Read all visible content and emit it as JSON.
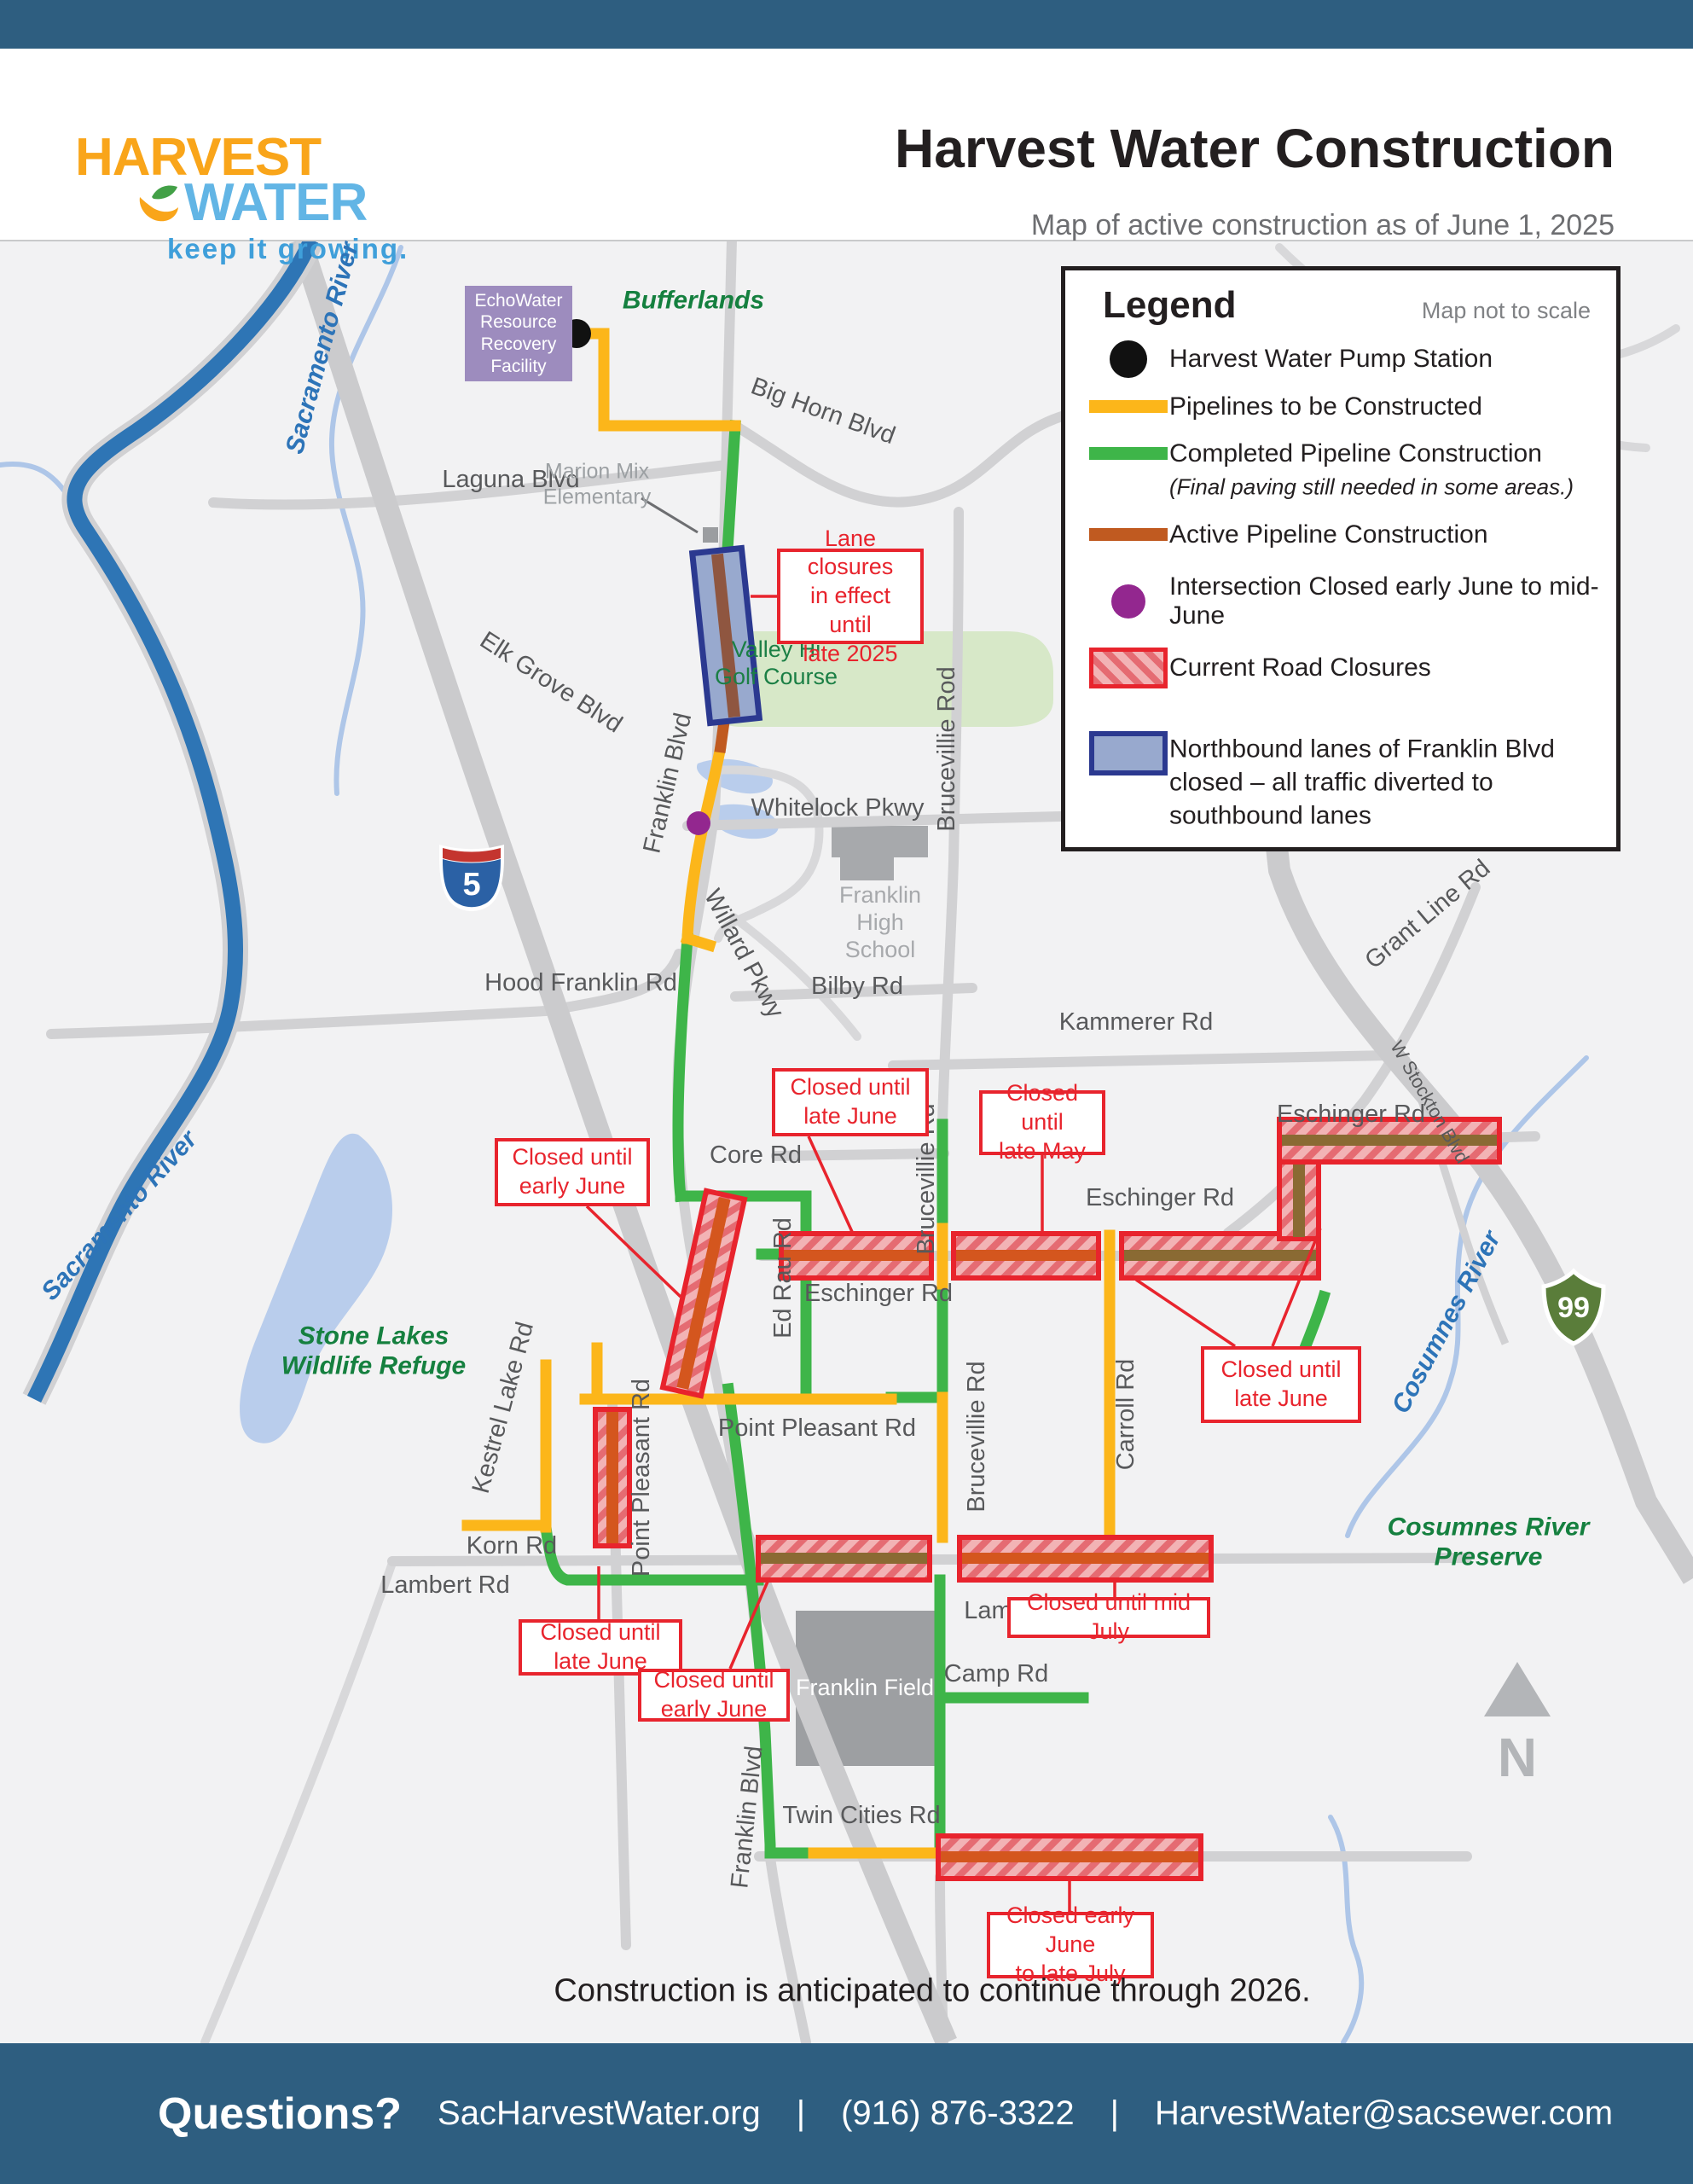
{
  "header": {
    "logo_line1": "HARVEST",
    "logo_line2": "WATER",
    "logo_tagline": "keep it growing.",
    "title": "Harvest Water Construction",
    "subtitle": "Map of active construction as of June 1, 2025"
  },
  "legend": {
    "title": "Legend",
    "scale_note": "Map not to scale",
    "items": [
      {
        "symbol": "pump-station-dot",
        "label": "Harvest Water Pump Station"
      },
      {
        "symbol": "yellow-line",
        "label": "Pipelines to be Constructed"
      },
      {
        "symbol": "green-line",
        "label": "Completed Pipeline Construction",
        "sublabel": "(Final paving still needed in some areas.)"
      },
      {
        "symbol": "orange-line",
        "label": "Active Pipeline Construction"
      },
      {
        "symbol": "purple-dot",
        "label": "Intersection Closed early June to mid-June"
      },
      {
        "symbol": "road-closure-swatch",
        "label": "Current Road Closures"
      },
      {
        "symbol": "nb-lanes-swatch",
        "label": "Northbound lanes of Franklin Blvd\nclosed – all traffic diverted to\nsouthbound lanes"
      }
    ]
  },
  "map": {
    "facility": "EchoWater\nResource\nRecovery\nFacility",
    "labels": {
      "bufferlands": "Bufferlands",
      "big_horn": "Big Horn Blvd",
      "laguna": "Laguna Blvd",
      "marion_mix": "Marion Mix\nElementary",
      "elk_grove": "Elk Grove Blvd",
      "valley_hi": "Valley Hi\nGolf Course",
      "whitelock": "Whitelock Pkwy",
      "bruceville_top": "Brucevillie Rod",
      "franklin_blvd_upper": "Franklin Blvd",
      "franklin_high": "Franklin\nHigh\nSchool",
      "hood_franklin": "Hood Franklin Rd",
      "willard": "Willard Pkwy",
      "bilby": "Bilby Rd",
      "kammerer": "Kammerer Rd",
      "grant_line": "Grant Line Rd",
      "sacramento_river_top": "Sacramento River",
      "sacramento_river_left": "Sacramento River",
      "core": "Core Rd",
      "bruceville_mid": "Brucevillie Rd",
      "eschinger_w": "Eschinger Rd",
      "eschinger_mid": "Eschinger Rd",
      "eschinger_e": "Eschinger Rd",
      "ed_rau": "Ed Rau Rd",
      "w_stockton": "W Stockton Blvd",
      "cosumnes_river": "Cosumnes River",
      "stone_lakes": "Stone Lakes\nWildlife Refuge",
      "kestrel": "Kestrel Lake Rd",
      "point_pleasant_v": "Point Pleasant Rd",
      "point_pleasant_h": "Point Pleasant Rd",
      "carroll": "Carroll Rd",
      "bruceville_bottom": "Brucevillie Rd",
      "korn": "Korn Rd",
      "lambert_w": "Lambert Rd",
      "lambert_e": "Lambert Rd",
      "camp": "Camp Rd",
      "franklin_field": "Franklin Field",
      "franklin_blvd_lower": "Franklin Blvd",
      "twin_cities": "Twin Cities Rd",
      "cosumnes_preserve": "Cosumnes River\nPreserve"
    },
    "callouts": [
      "Lane closures\nin effect until\nlate 2025",
      "Closed until\nlate June",
      "Closed until\nlate May",
      "Closed until\nearly June",
      "Closed until\nlate June",
      "Closed until\nlate June",
      "Closed until\nearly June",
      "Closed until mid July",
      "Closed early June\nto late July"
    ],
    "shields": {
      "interstate": "5",
      "state_route": "99"
    },
    "north": "N",
    "note": "Construction is anticipated to continue through 2026."
  },
  "colors": {
    "bar_blue": "#2e5e80",
    "pipeline_yellow": "#fcb61a",
    "pipeline_green": "#3eb549",
    "pipeline_orange": "#c05a20",
    "closure_red": "#e8242d",
    "intersection_purple": "#93278f",
    "nb_box_blue": "#2b3990",
    "logo_yellow": "#f9a51a",
    "logo_blue": "#62b5e5"
  },
  "footer": {
    "question_label": "Questions?",
    "website": "SacHarvestWater.org",
    "separator": "|",
    "phone": "(916) 876-3322",
    "email": "HarvestWater@sacsewer.com"
  }
}
